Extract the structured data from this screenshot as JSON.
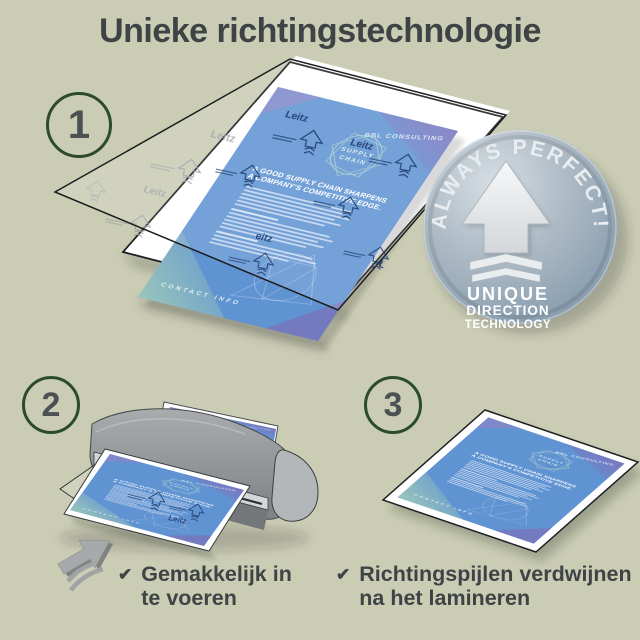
{
  "page": {
    "title": "Unieke richtingstechnologie",
    "background_color": "#cbccb4",
    "title_color": "#3e4446"
  },
  "steps": [
    {
      "number": "1"
    },
    {
      "number": "2"
    },
    {
      "number": "3"
    }
  ],
  "badge": {
    "arc_text": "ALWAYS PERFECT!",
    "line1": "UNIQUE",
    "line2": "DIRECTION",
    "line3": "TECHNOLOGY",
    "metal_color": "#9fb0bf"
  },
  "brochure": {
    "brand": "BBL CONSULTING",
    "emblem_line1": "SUPPLY",
    "emblem_line2": "CHAIN",
    "heading_line1": "A GOOD SUPPLY CHAIN SHARPENS",
    "heading_line2": "A COMPANY'S COMPETITIVE EDGE.",
    "footer": "CONTACT INFO",
    "paper_color": "#6093d2"
  },
  "pouch": {
    "brand": "Leitz",
    "arrow_color": "#1e3c70"
  },
  "checklist": [
    {
      "label": "Gemakkelijk in te voeren"
    },
    {
      "label": "Richtingspijlen verdwijnen na het lamineren"
    }
  ],
  "icons": {
    "check": "✔"
  },
  "colors": {
    "step_ring_green": "#2b4c28",
    "step_number_gray": "#4b5052",
    "text_dark": "#3e4446",
    "machine_gray": "#8b8f91"
  }
}
